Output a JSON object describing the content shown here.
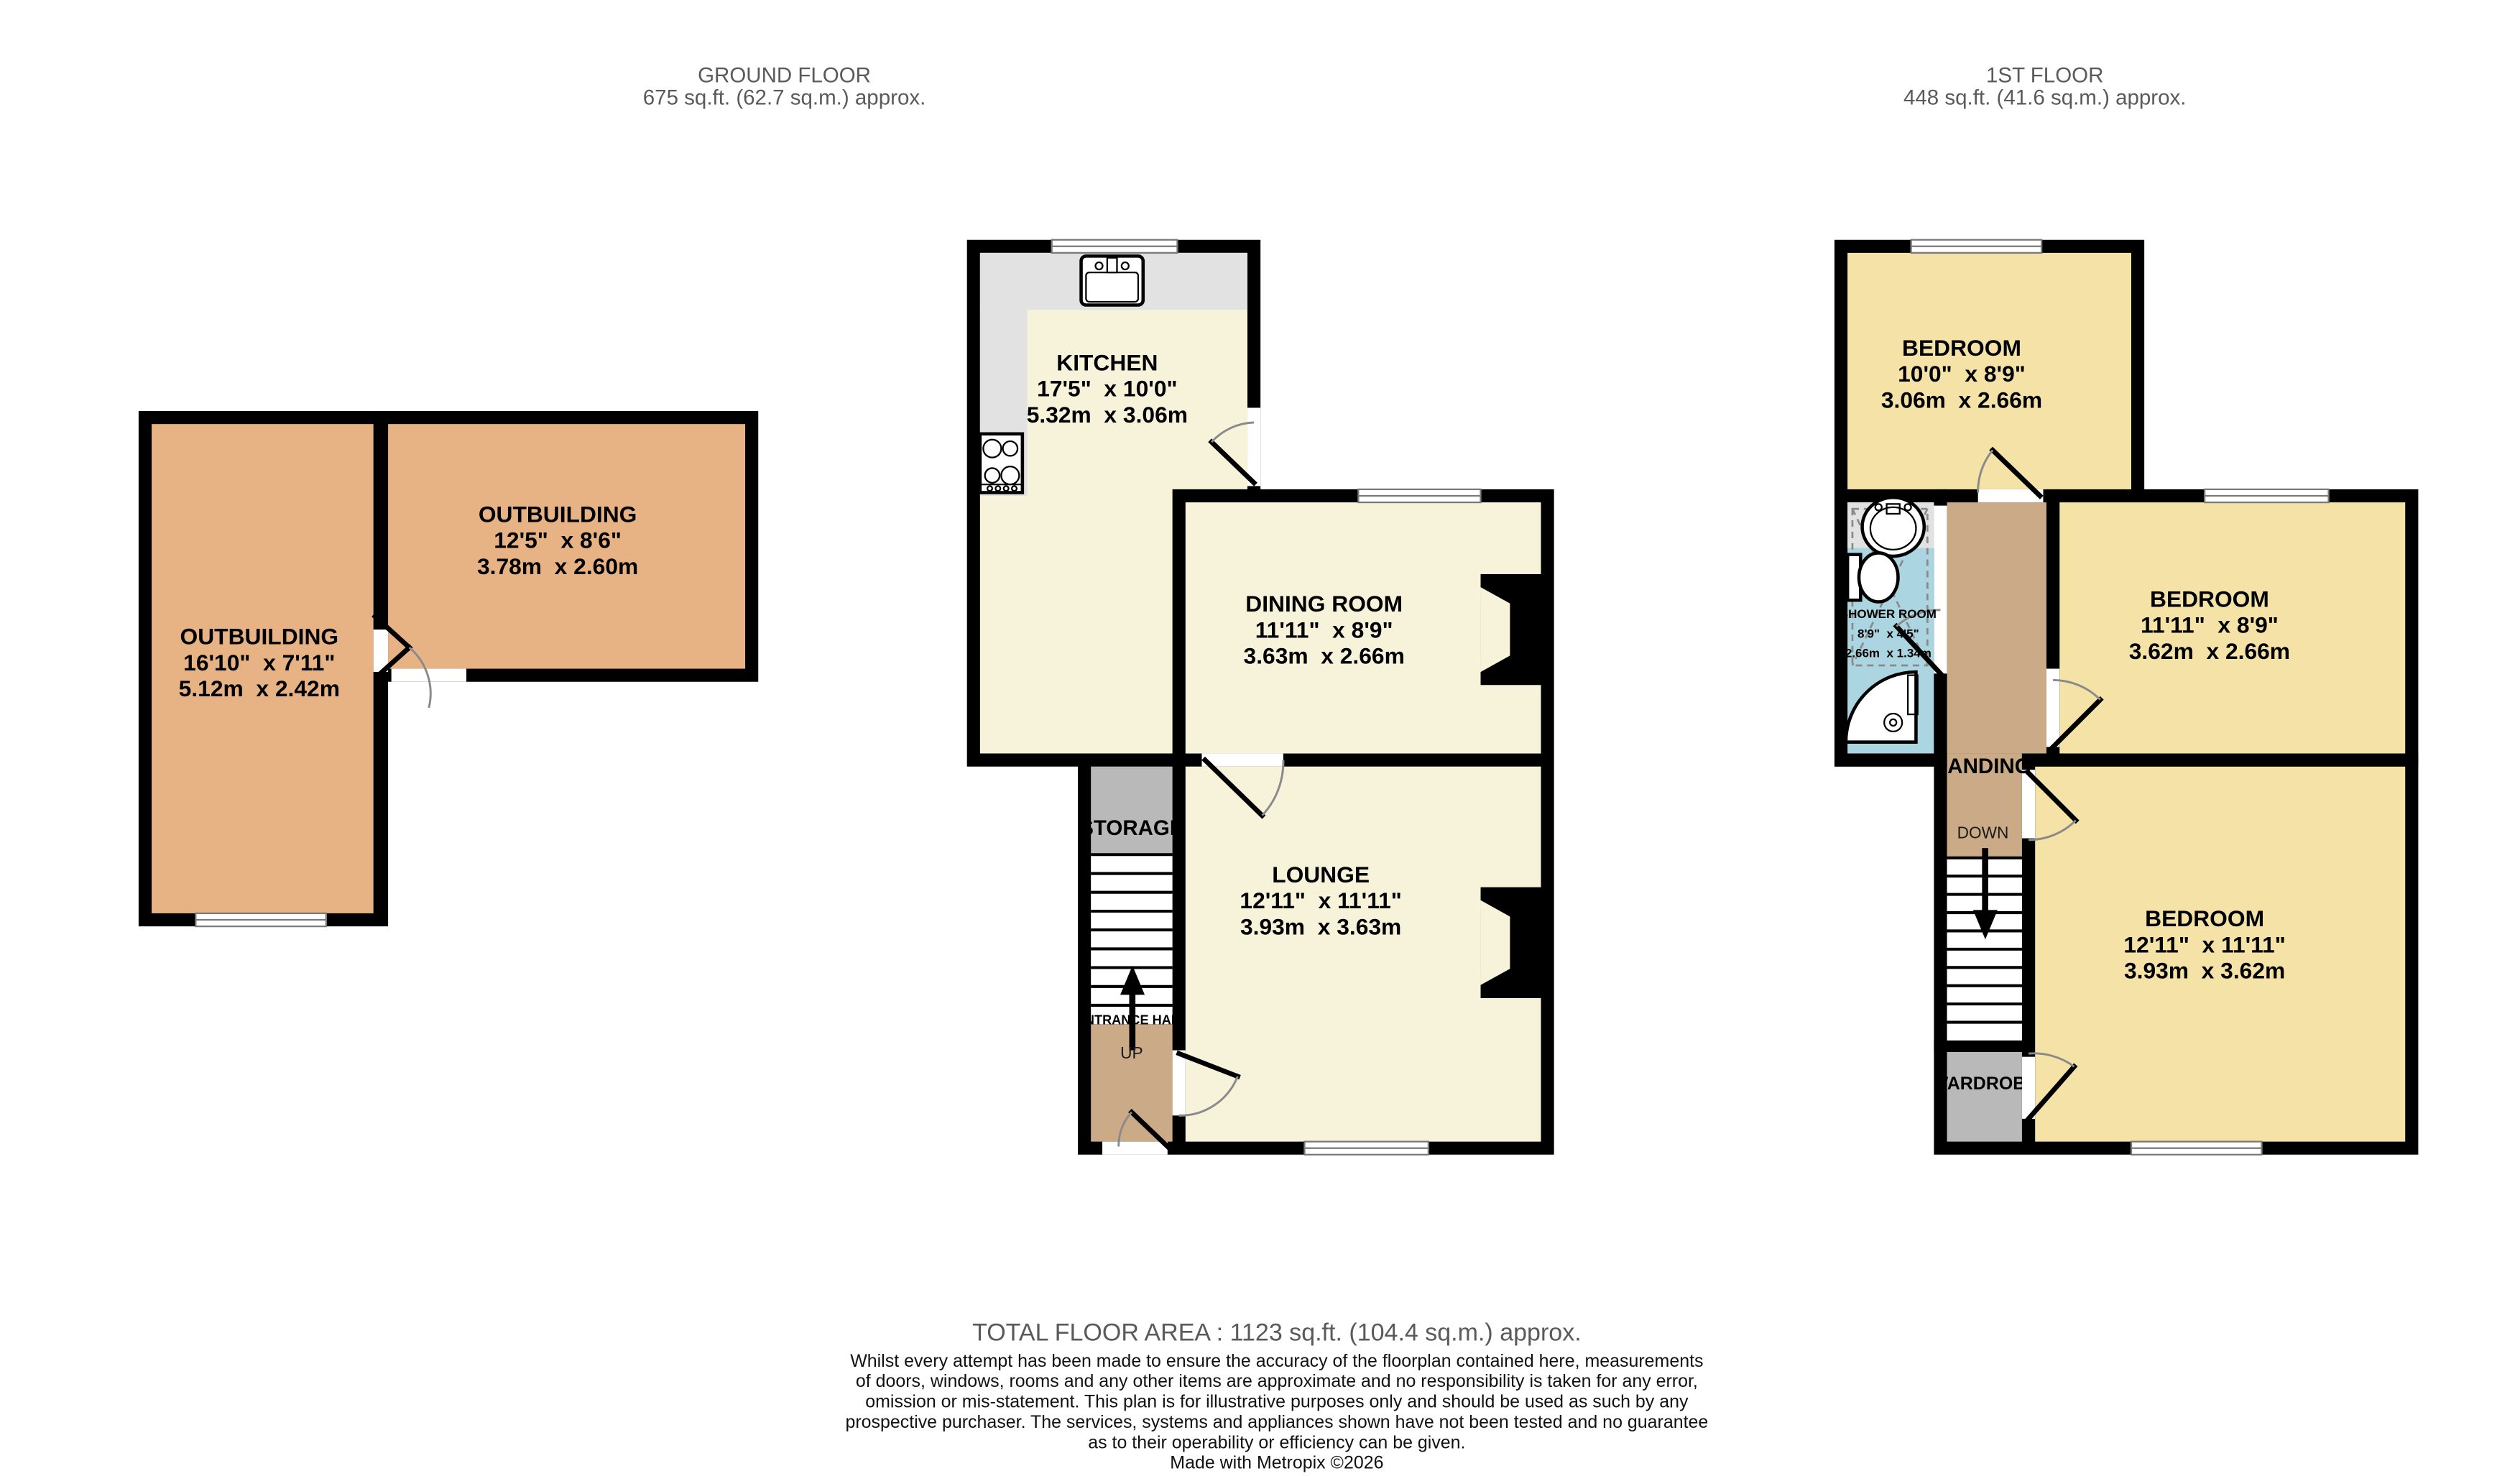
{
  "header": {
    "ground_floor_title": "GROUND FLOOR",
    "ground_floor_area": "675 sq.ft. (62.7 sq.m.) approx.",
    "first_floor_title": "1ST FLOOR",
    "first_floor_area": "448 sq.ft. (41.6 sq.m.) approx."
  },
  "rooms": {
    "outbuilding_left": {
      "name": "OUTBUILDING",
      "imperial": "16'10\"  x 7'11\"",
      "metric": "5.12m  x 2.42m"
    },
    "outbuilding_right": {
      "name": "OUTBUILDING",
      "imperial": "12'5\"  x 8'6\"",
      "metric": "3.78m  x 2.60m"
    },
    "kitchen": {
      "name": "KITCHEN",
      "imperial": "17'5\"  x 10'0\"",
      "metric": "5.32m  x 3.06m"
    },
    "dining_room": {
      "name": "DINING ROOM",
      "imperial": "11'11\"  x 8'9\"",
      "metric": "3.63m  x 2.66m"
    },
    "lounge": {
      "name": "LOUNGE",
      "imperial": "12'11\"  x 11'11\"",
      "metric": "3.93m  x 3.63m"
    },
    "storage": {
      "name": "STORAGE"
    },
    "entrance_hall": {
      "name": "ENTRANCE HALL",
      "up": "UP"
    },
    "bedroom_front": {
      "name": "BEDROOM",
      "imperial": "10'0\"  x 8'9\"",
      "metric": "3.06m  x 2.66m"
    },
    "bedroom_middle": {
      "name": "BEDROOM",
      "imperial": "11'11\"  x 8'9\"",
      "metric": "3.62m  x 2.66m"
    },
    "bedroom_back": {
      "name": "BEDROOM",
      "imperial": "12'11\"  x 11'11\"",
      "metric": "3.93m  x 3.62m"
    },
    "shower_room": {
      "name": "SHOWER ROOM",
      "imperial": "8'9\"  x 4'5\"",
      "metric": "2.66m  x 1.34m"
    },
    "landing": {
      "name": "LANDING",
      "down": "DOWN"
    },
    "wardrobe": {
      "name": "WARDROBE"
    }
  },
  "footer": {
    "total": "TOTAL FLOOR AREA : 1123 sq.ft. (104.4 sq.m.) approx.",
    "disclaimer": [
      "Whilst every attempt has been made to ensure the accuracy of the floorplan contained here, measurements",
      "of doors, windows, rooms and any other items are approximate and no responsibility is taken for any error,",
      "omission or mis-statement. This plan is for illustrative purposes only and should be used as such by any",
      "prospective purchaser. The services, systems and appliances shown have not been tested and no guarantee",
      "as to their operability or efficiency can be given.",
      "Made with Metropix ©2026"
    ]
  },
  "colors": {
    "wall": "#000000",
    "room_cream": "#f7f3da",
    "bedroom_yellow": "#f5e2a7",
    "outbuilding_tan": "#e8b384",
    "hall_tan": "#cbab87",
    "storage_gray": "#b9b9b9",
    "counter_gray": "#e2e2e2",
    "shower_blue": "#abd5e1",
    "annotation_gray": "#5a5a5a"
  }
}
